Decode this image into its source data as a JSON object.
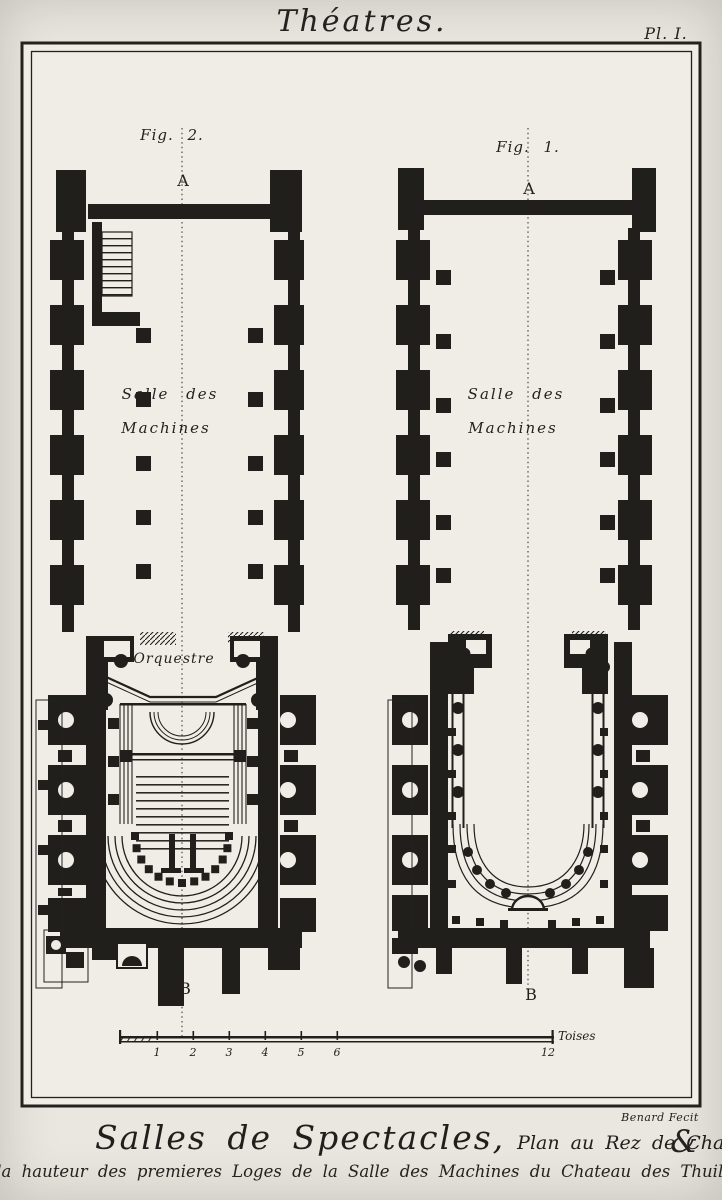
{
  "plate": {
    "title": "Théatres.",
    "plate_number": "Pl. I.",
    "engraver_credit": "Benard Fecit",
    "caption": {
      "line1_main": "Salles de Spectacles,",
      "line1_detail": "Plan au Rez de Chaußée, et ~",
      "ampersand": "&",
      "line2": "Plan a la hauteur des premieres Loges de la Salle des Machines du Chateau des Thuilleries."
    }
  },
  "fig2": {
    "label": "Fig. 2.",
    "section_marker_top": "A",
    "section_marker_bottom": "B",
    "room_line1": "Salle des",
    "room_line2": "Machines",
    "orchestra": "Orquestre"
  },
  "fig1": {
    "label": "Fig. 1.",
    "section_marker_top": "A",
    "section_marker_bottom": "B",
    "room_line1": "Salle des",
    "room_line2": "Machines"
  },
  "scalebar": {
    "unit": "Toises",
    "ticks": [
      "1",
      "2",
      "3",
      "4",
      "5",
      "6",
      "12"
    ]
  },
  "colors": {
    "paper": "#efede6",
    "ink": "#201f1c"
  }
}
